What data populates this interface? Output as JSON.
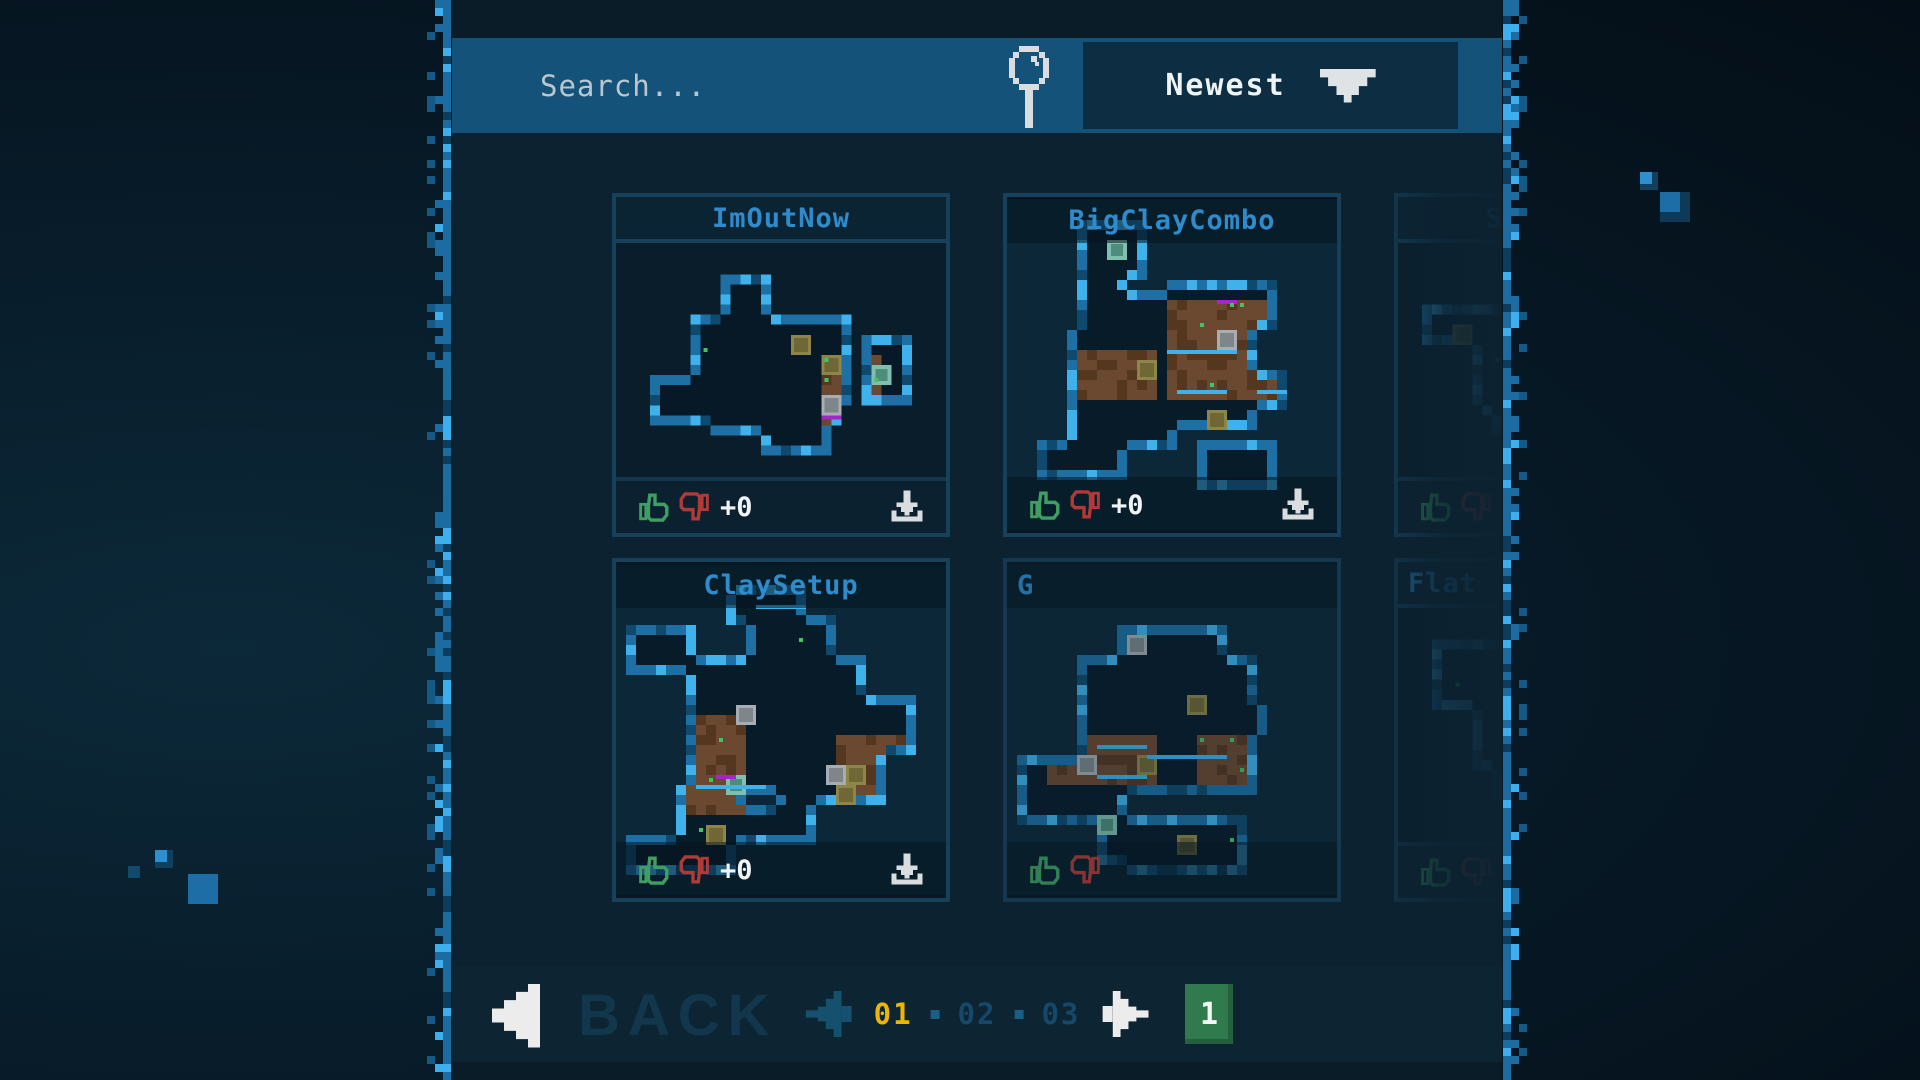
{
  "header": {
    "search_placeholder": "Search...",
    "sort_value": "Newest"
  },
  "levels": [
    {
      "title": "ImOutNow",
      "vote_count": "+0",
      "layout": "framed",
      "partial": false
    },
    {
      "title": "BigClayCombo",
      "vote_count": "+0",
      "layout": "full",
      "partial": false
    },
    {
      "title": "SmallCave",
      "vote_count": "+0",
      "layout": "framed",
      "partial": false
    },
    {
      "title": "ClaySetup",
      "vote_count": "+0",
      "layout": "full",
      "partial": false
    },
    {
      "title": "G",
      "vote_count": "",
      "layout": "full",
      "partial": true
    },
    {
      "title": "Flat",
      "vote_count": "",
      "layout": "framed",
      "partial": true
    }
  ],
  "footer": {
    "back_label": "BACK",
    "pages": [
      {
        "label": "01",
        "current": true
      },
      {
        "label": "02",
        "current": false
      },
      {
        "label": "03",
        "current": false
      }
    ],
    "selected_badge": "1"
  },
  "colors": {
    "header_bar": "#15527a",
    "title_blue": "#2e8ccc",
    "page_current_yellow": "#e9b50b",
    "badge_green": "#2f7b4d",
    "like_green": "#3f9e63",
    "dislike_red": "#b03a37",
    "border_pixel_blue": "#2f97d8"
  }
}
